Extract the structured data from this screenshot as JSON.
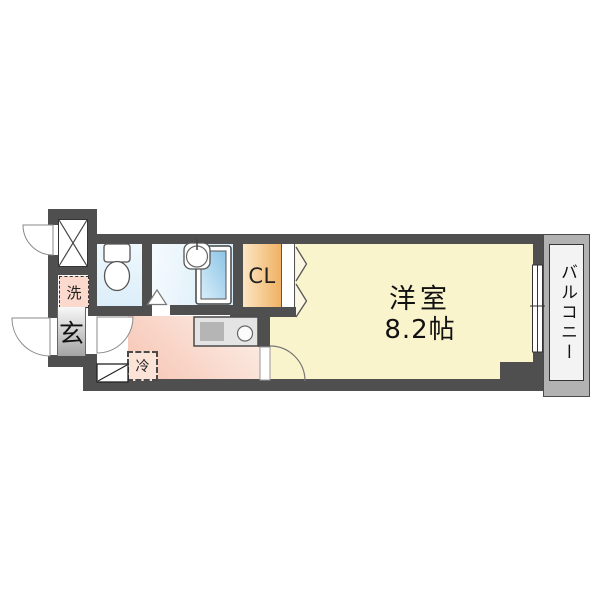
{
  "plan": {
    "type": "apartment-floor-plan",
    "labels": {
      "main_room_name": "洋室",
      "main_room_size": "8.2帖",
      "closet": "CL",
      "balcony": "バルコニー",
      "entrance": "玄",
      "washer": "洗",
      "refrigerator": "冷"
    },
    "fixtures": [
      "meter-box-x",
      "toilet",
      "wash-basin",
      "bathtub",
      "kitchen-counter",
      "kitchen-sink",
      "burner",
      "shoe-cabinet",
      "refrigerator-space",
      "washer-space",
      "closet-folding-door",
      "sliding-window",
      "entrance-door",
      "meter-box-door",
      "hall-door",
      "room-door",
      "bath-door-triangle"
    ],
    "colors": {
      "wall": "#4f4f4f",
      "room_floor": "#faf4cd",
      "kitchen_light": "#fdf0e9",
      "kitchen_deep": "#f6c6b5",
      "toilet_floor_light": "#eff8fd",
      "toilet_floor_deep": "#dceef9",
      "bath_floor_light": "#f6fbfe",
      "bath_floor_deep": "#d5ebf7",
      "closet_light": "#fbe7c4",
      "closet_deep": "#f0b163",
      "bathtub_light": "#d9eefa",
      "bathtub_deep": "#8cc4e6",
      "genkan_light": "#f8f8f8",
      "genkan_deep": "#a4a4a4",
      "washer_bg": "#fbd9cc",
      "fridge_bg": "#fbe3d8",
      "balcony_band": "#b2b2b2",
      "balcony_inner": "#f3f3f3"
    }
  }
}
